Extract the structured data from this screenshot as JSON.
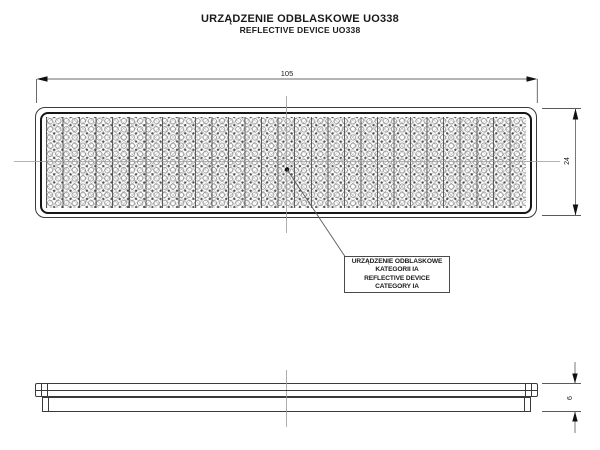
{
  "drawing": {
    "title_pl": "URZĄDZENIE ODBLASKOWE UO338",
    "title_en": "REFLECTIVE DEVICE UO338",
    "dimensions": {
      "width_mm": "105",
      "height_mm": "24",
      "thickness_mm": "6"
    },
    "callout_lines": [
      "URZĄDZENIE ODBLASKOWE",
      "KATEGORII IA",
      "REFLECTIVE DEVICE",
      "CATEGORY IA"
    ],
    "colors": {
      "background": "#ffffff",
      "outline": "#3a3a3a",
      "bezel": "#161616",
      "dimension_line": "#6a6a6a",
      "centerline": "#9a9a9a",
      "text": "#1a1a1a",
      "pattern": "#8a8a8a"
    }
  }
}
